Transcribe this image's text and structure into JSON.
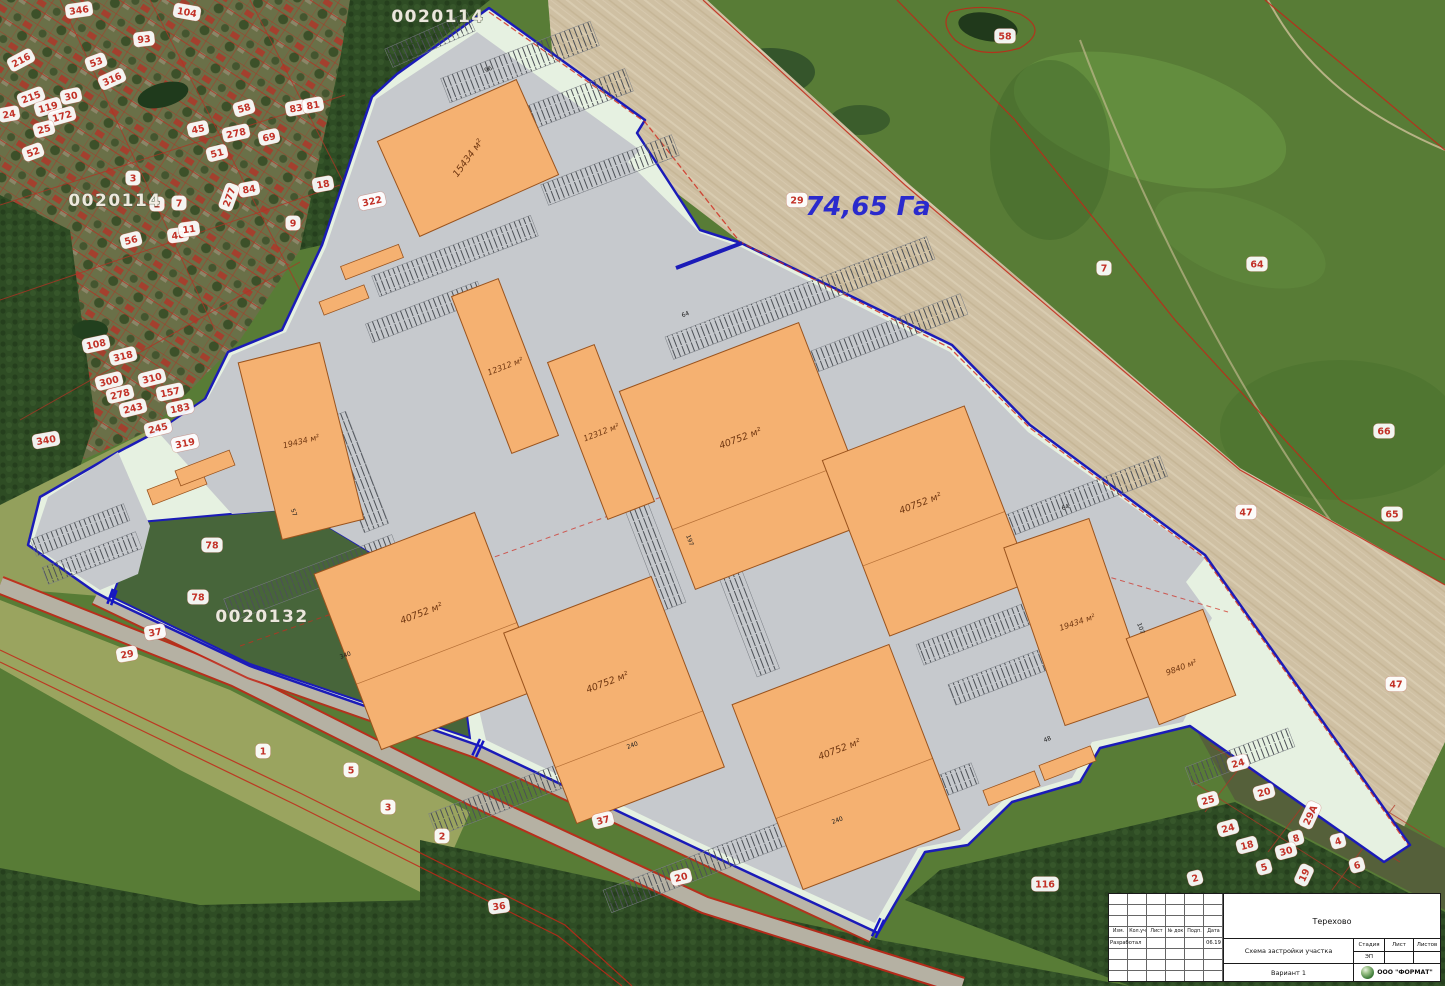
{
  "colors": {
    "site_boundary": "#1b1bb8",
    "building_fill": "#f5b171",
    "cadastral_red": "#c22718",
    "pavement": "#c6c9cd",
    "site_margin": "#e6f1e1",
    "area_text": "#2a2acd",
    "parcel_text": "#c23127"
  },
  "map": {
    "area_label": {
      "text": "74,65 Га"
    },
    "cadastral_codes": [
      {
        "text": "0020114"
      },
      {
        "text": "0020114"
      },
      {
        "text": "0020132"
      }
    ],
    "parcel_numbers": [
      {
        "label": "346",
        "x": 79,
        "y": 10,
        "r": -8
      },
      {
        "label": "104",
        "x": 187,
        "y": 12,
        "r": 10
      },
      {
        "label": "93",
        "x": 144,
        "y": 39,
        "r": -6
      },
      {
        "label": "216",
        "x": 21,
        "y": 60,
        "r": -28
      },
      {
        "label": "53",
        "x": 96,
        "y": 62,
        "r": -20
      },
      {
        "label": "316",
        "x": 112,
        "y": 79,
        "r": -24
      },
      {
        "label": "215",
        "x": 31,
        "y": 97,
        "r": -20
      },
      {
        "label": "30",
        "x": 71,
        "y": 96,
        "r": -12
      },
      {
        "label": "119",
        "x": 48,
        "y": 107,
        "r": -16
      },
      {
        "label": "172",
        "x": 62,
        "y": 116,
        "r": -16
      },
      {
        "label": "24",
        "x": 9,
        "y": 114,
        "r": -10
      },
      {
        "label": "25",
        "x": 44,
        "y": 129,
        "r": -14
      },
      {
        "label": "52",
        "x": 33,
        "y": 152,
        "r": -20
      },
      {
        "label": "58",
        "x": 244,
        "y": 108,
        "r": -16
      },
      {
        "label": "45",
        "x": 198,
        "y": 129,
        "r": -12
      },
      {
        "label": "278",
        "x": 236,
        "y": 133,
        "r": -12
      },
      {
        "label": "69",
        "x": 269,
        "y": 137,
        "r": -12
      },
      {
        "label": "51",
        "x": 217,
        "y": 153,
        "r": -14
      },
      {
        "label": "84",
        "x": 249,
        "y": 189,
        "r": -10
      },
      {
        "label": "277",
        "x": 229,
        "y": 197,
        "r": -70
      },
      {
        "label": "83",
        "x": 296,
        "y": 108,
        "r": -10
      },
      {
        "label": "81",
        "x": 313,
        "y": 105,
        "r": -10
      },
      {
        "label": "3",
        "x": 133,
        "y": 178,
        "r": 0
      },
      {
        "label": "2",
        "x": 157,
        "y": 204,
        "r": 0
      },
      {
        "label": "7",
        "x": 179,
        "y": 203,
        "r": 0
      },
      {
        "label": "48",
        "x": 178,
        "y": 235,
        "r": -8
      },
      {
        "label": "11",
        "x": 189,
        "y": 229,
        "r": -8
      },
      {
        "label": "56",
        "x": 131,
        "y": 240,
        "r": -14
      },
      {
        "label": "9",
        "x": 293,
        "y": 223,
        "r": 0
      },
      {
        "label": "18",
        "x": 323,
        "y": 184,
        "r": -10
      },
      {
        "label": "108",
        "x": 96,
        "y": 344,
        "r": -12
      },
      {
        "label": "300",
        "x": 109,
        "y": 381,
        "r": -14
      },
      {
        "label": "310",
        "x": 152,
        "y": 378,
        "r": -14
      },
      {
        "label": "278",
        "x": 120,
        "y": 394,
        "r": -14
      },
      {
        "label": "243",
        "x": 133,
        "y": 408,
        "r": -14
      },
      {
        "label": "245",
        "x": 158,
        "y": 428,
        "r": -14
      },
      {
        "label": "183",
        "x": 180,
        "y": 408,
        "r": -12
      },
      {
        "label": "318",
        "x": 123,
        "y": 356,
        "r": -14
      },
      {
        "label": "340",
        "x": 46,
        "y": 440,
        "r": -10
      },
      {
        "label": "319",
        "x": 185,
        "y": 443,
        "r": -12
      },
      {
        "label": "322",
        "x": 372,
        "y": 201,
        "r": -12
      },
      {
        "label": "157",
        "x": 170,
        "y": 392,
        "r": -12
      },
      {
        "label": "58",
        "x": 1005,
        "y": 36,
        "r": 0
      },
      {
        "label": "29",
        "x": 797,
        "y": 200,
        "r": 0
      },
      {
        "label": "7",
        "x": 1104,
        "y": 268,
        "r": 0
      },
      {
        "label": "64",
        "x": 1257,
        "y": 264,
        "r": 0
      },
      {
        "label": "66",
        "x": 1384,
        "y": 431,
        "r": 0
      },
      {
        "label": "65",
        "x": 1392,
        "y": 514,
        "r": 0
      },
      {
        "label": "47",
        "x": 1246,
        "y": 512,
        "r": 0
      },
      {
        "label": "47",
        "x": 1396,
        "y": 684,
        "r": 0
      },
      {
        "label": "37",
        "x": 155,
        "y": 632,
        "r": -10
      },
      {
        "label": "29",
        "x": 127,
        "y": 654,
        "r": -10
      },
      {
        "label": "1",
        "x": 263,
        "y": 751,
        "r": 0
      },
      {
        "label": "5",
        "x": 351,
        "y": 770,
        "r": 0
      },
      {
        "label": "3",
        "x": 388,
        "y": 807,
        "r": 0
      },
      {
        "label": "2",
        "x": 442,
        "y": 836,
        "r": 0
      },
      {
        "label": "36",
        "x": 499,
        "y": 906,
        "r": -8
      },
      {
        "label": "37",
        "x": 603,
        "y": 820,
        "r": -14
      },
      {
        "label": "20",
        "x": 681,
        "y": 877,
        "r": -14
      },
      {
        "label": "116",
        "x": 1045,
        "y": 884,
        "r": 0
      },
      {
        "label": "78",
        "x": 212,
        "y": 545,
        "r": 0
      },
      {
        "label": "78",
        "x": 198,
        "y": 597,
        "r": 0
      },
      {
        "label": "24",
        "x": 1238,
        "y": 763,
        "r": -15
      },
      {
        "label": "20",
        "x": 1264,
        "y": 792,
        "r": -15
      },
      {
        "label": "25",
        "x": 1208,
        "y": 800,
        "r": -15
      },
      {
        "label": "29А",
        "x": 1310,
        "y": 815,
        "r": -65
      },
      {
        "label": "24",
        "x": 1228,
        "y": 828,
        "r": -15
      },
      {
        "label": "18",
        "x": 1247,
        "y": 845,
        "r": -15
      },
      {
        "label": "8",
        "x": 1296,
        "y": 838,
        "r": -15
      },
      {
        "label": "4",
        "x": 1338,
        "y": 841,
        "r": -15
      },
      {
        "label": "5",
        "x": 1264,
        "y": 867,
        "r": -15
      },
      {
        "label": "19",
        "x": 1304,
        "y": 875,
        "r": -65
      },
      {
        "label": "6",
        "x": 1357,
        "y": 865,
        "r": -15
      },
      {
        "label": "2",
        "x": 1195,
        "y": 878,
        "r": -15
      },
      {
        "label": "30",
        "x": 1286,
        "y": 851,
        "r": -15
      }
    ],
    "dimensions": [
      {
        "label": "64",
        "x": 686,
        "y": 316,
        "r": -21
      },
      {
        "label": "197",
        "x": 688,
        "y": 541,
        "r": 69
      },
      {
        "label": "240",
        "x": 633,
        "y": 747,
        "r": -21
      },
      {
        "label": "240",
        "x": 838,
        "y": 822,
        "r": -21
      },
      {
        "label": "340",
        "x": 346,
        "y": 657,
        "r": -21
      },
      {
        "label": "57",
        "x": 292,
        "y": 513,
        "r": 69
      },
      {
        "label": "107",
        "x": 1139,
        "y": 629,
        "r": 69
      },
      {
        "label": "96",
        "x": 489,
        "y": 71,
        "r": -24
      },
      {
        "label": "64",
        "x": 1066,
        "y": 509,
        "r": -21
      },
      {
        "label": "48",
        "x": 1048,
        "y": 741,
        "r": -21
      }
    ]
  },
  "buildings": [
    {
      "label": "15434 м²"
    },
    {
      "label": "19434 м²"
    },
    {
      "label": "12312 м²"
    },
    {
      "label": "12312 м²"
    },
    {
      "label": "40752 м²"
    },
    {
      "label": "40752 м²"
    },
    {
      "label": "40752 м²"
    },
    {
      "label": "40752 м²"
    },
    {
      "label": "40752 м²"
    },
    {
      "label": "19434 м²"
    },
    {
      "label": "9840 м²"
    }
  ],
  "title_block": {
    "project": "Терехово",
    "scheme_title": "Схема застройки участка",
    "variant": "Вариант 1",
    "stage_label": "Стадия",
    "sheet_label": "Лист",
    "sheets_label": "Листов",
    "stage_value": "ЭП",
    "columns": [
      "Изм.",
      "Кол.уч",
      "Лист",
      "№ док",
      "Подп.",
      "Дата"
    ],
    "developed_label": "Разработал",
    "date_value": "06.19",
    "company": "ООО \"ФОРМАТ\""
  }
}
